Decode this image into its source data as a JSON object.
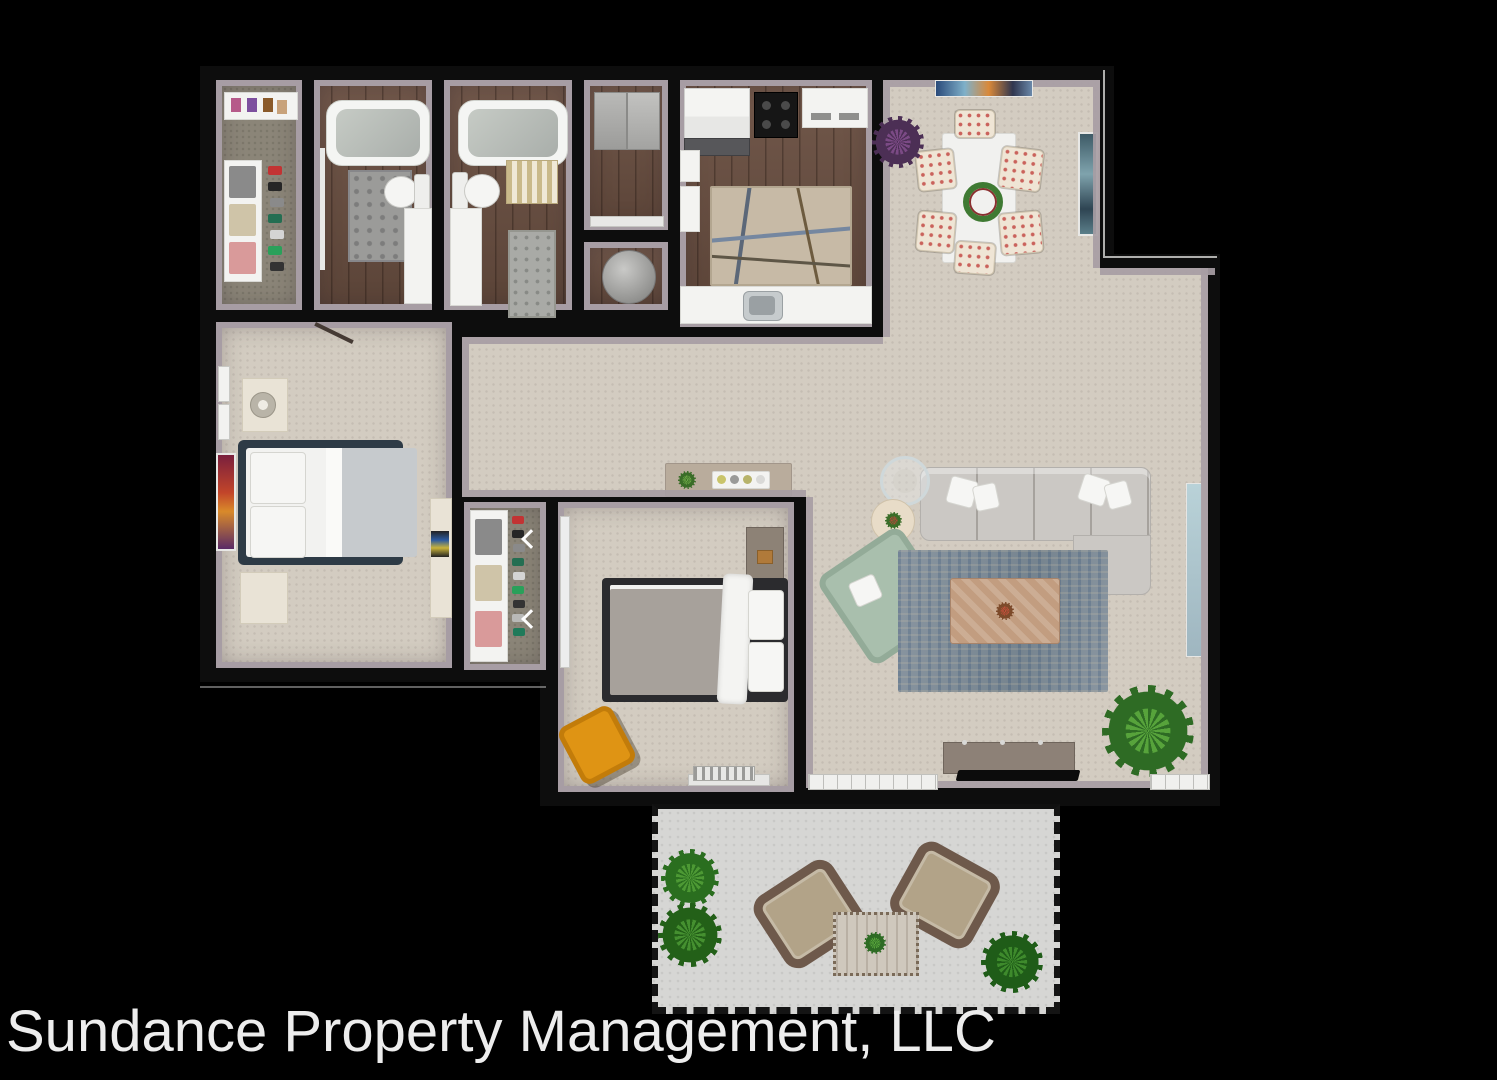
{
  "caption": {
    "text": "Sundance Property Management, LLC"
  },
  "palette": {
    "bg": "#000000",
    "wall": "#0d0d0d",
    "cap": "#a79da4",
    "carpet": "#d3ccc1",
    "wood": "#6a4f41",
    "closetfloor": "#8b8578",
    "patiofloor": "#d6d6d4",
    "ruglive": "#82919d",
    "rugkitchen": "#c7baa6",
    "sofa": "#cbc8c4",
    "greenchair": "#a9bfad",
    "coffee": "#c29d80",
    "navy": "#2e3b46",
    "orange": "#df9414",
    "wicker": "#6e594b",
    "cushion": "#b2a388",
    "plant1": "#2e6b24",
    "plant2": "#57a33b",
    "purple1": "#4c2f55",
    "purple2": "#7b4a85",
    "mirror": "#b9d2d8",
    "dtable": "#f1f1ef",
    "console": "#8d8177",
    "captioncolor": "#ededed"
  },
  "rooms": [
    {
      "name": "walk-in-closet",
      "furniture": [
        "shoe-shelf",
        "clothes-shelving",
        "hanging-clothes"
      ]
    },
    {
      "name": "bathroom-1",
      "furniture": [
        "bathtub",
        "toilet",
        "vanity",
        "rug",
        "door"
      ]
    },
    {
      "name": "bathroom-2",
      "furniture": [
        "bathtub",
        "toilet",
        "vanity",
        "striped-rug",
        "bath-mat"
      ]
    },
    {
      "name": "storage-closet",
      "furniture": [
        "cabinets",
        "counter"
      ]
    },
    {
      "name": "utility-closet",
      "furniture": [
        "water-heater"
      ]
    },
    {
      "name": "kitchen",
      "furniture": [
        "refrigerator",
        "stove",
        "appliance",
        "counters",
        "sink",
        "area-rug"
      ]
    },
    {
      "name": "dining-area",
      "furniture": [
        "dining-table",
        "six-chairs",
        "wreath-centerpiece",
        "wall-art",
        "potted-plant"
      ]
    },
    {
      "name": "living-room",
      "furniture": [
        "sectional-sofa",
        "accent-chair",
        "coffee-table",
        "glass-side-table",
        "round-side-table",
        "area-rug",
        "media-console",
        "tv",
        "floor-plant",
        "mirror",
        "patio-door",
        "window"
      ]
    },
    {
      "name": "master-bedroom",
      "furniture": [
        "bed",
        "nightstand",
        "lamp",
        "bench",
        "dresser",
        "tv",
        "wall-art",
        "windows",
        "door"
      ]
    },
    {
      "name": "hallway",
      "furniture": [
        "console-table",
        "decor-tray",
        "small-plant"
      ]
    },
    {
      "name": "hall-closet",
      "furniture": [
        "clothes-shelving",
        "shoe-rack",
        "bifold-doors"
      ]
    },
    {
      "name": "bedroom-2",
      "furniture": [
        "bed",
        "dresser",
        "desk-chair",
        "baseboard-heater"
      ]
    },
    {
      "name": "patio",
      "furniture": [
        "wicker-chair",
        "wicker-chair",
        "wicker-table",
        "hedge",
        "potted-plant",
        "railing"
      ]
    }
  ]
}
